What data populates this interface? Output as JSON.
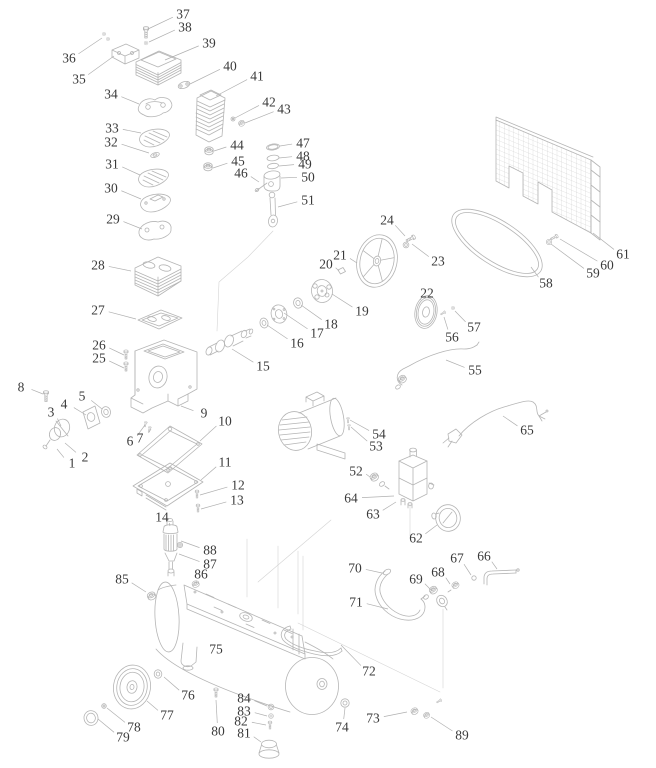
{
  "figure": {
    "type": "exploded-parts-diagram",
    "subject": "air compressor assembly",
    "part_count": 89
  },
  "style": {
    "background": "#ffffff",
    "linework_color": "#b5b5b5",
    "construction_line_color": "#d0d0d0",
    "leader_color": "#b0b0b0",
    "label_color": "#3a3a3a"
  },
  "canvas": {
    "width": 656,
    "height": 768
  },
  "labels": [
    {
      "n": "1",
      "x": 72,
      "y": 463,
      "tx": 57,
      "ty": 449
    },
    {
      "n": "2",
      "x": 85,
      "y": 457,
      "tx": 65,
      "ty": 443
    },
    {
      "n": "3",
      "x": 51,
      "y": 412,
      "tx": 61,
      "ty": 426
    },
    {
      "n": "4",
      "x": 64,
      "y": 404,
      "tx": 86,
      "ty": 415
    },
    {
      "n": "5",
      "x": 82,
      "y": 396,
      "tx": 102,
      "ty": 409
    },
    {
      "n": "6",
      "x": 130,
      "y": 441,
      "tx": 145,
      "ty": 425
    },
    {
      "n": "7",
      "x": 140,
      "y": 438,
      "tx": 151,
      "ty": 429
    },
    {
      "n": "8",
      "x": 21,
      "y": 387,
      "tx": 43,
      "ty": 394
    },
    {
      "n": "9",
      "x": 204,
      "y": 413,
      "tx": 181,
      "ty": 406
    },
    {
      "n": "10",
      "x": 225,
      "y": 421,
      "tx": 200,
      "ty": 441
    },
    {
      "n": "11",
      "x": 225,
      "y": 462,
      "tx": 201,
      "ty": 480
    },
    {
      "n": "12",
      "x": 238,
      "y": 485,
      "tx": 200,
      "ty": 495
    },
    {
      "n": "13",
      "x": 237,
      "y": 500,
      "tx": 201,
      "ty": 509
    },
    {
      "n": "14",
      "x": 162,
      "y": 517,
      "tx": 170,
      "ty": 526
    },
    {
      "n": "15",
      "x": 263,
      "y": 366,
      "tx": 232,
      "ty": 349
    },
    {
      "n": "16",
      "x": 297,
      "y": 343,
      "tx": 267,
      "ty": 325
    },
    {
      "n": "17",
      "x": 317,
      "y": 333,
      "tx": 284,
      "ty": 313
    },
    {
      "n": "18",
      "x": 331,
      "y": 324,
      "tx": 301,
      "ty": 305
    },
    {
      "n": "19",
      "x": 362,
      "y": 311,
      "tx": 332,
      "ty": 294
    },
    {
      "n": "20",
      "x": 326,
      "y": 264,
      "tx": 339,
      "ty": 271
    },
    {
      "n": "21",
      "x": 340,
      "y": 255,
      "tx": 357,
      "ty": 263
    },
    {
      "n": "22",
      "x": 427,
      "y": 293,
      "tx": 421,
      "ty": 300
    },
    {
      "n": "23",
      "x": 438,
      "y": 261,
      "tx": 412,
      "ty": 244
    },
    {
      "n": "24",
      "x": 387,
      "y": 220,
      "tx": 405,
      "ty": 236
    },
    {
      "n": "25",
      "x": 99,
      "y": 358,
      "tx": 124,
      "ty": 368
    },
    {
      "n": "26",
      "x": 99,
      "y": 345,
      "tx": 124,
      "ty": 355
    },
    {
      "n": "27",
      "x": 98,
      "y": 310,
      "tx": 136,
      "ty": 319
    },
    {
      "n": "28",
      "x": 98,
      "y": 265,
      "tx": 131,
      "ty": 271
    },
    {
      "n": "29",
      "x": 113,
      "y": 219,
      "tx": 142,
      "ty": 229
    },
    {
      "n": "30",
      "x": 111,
      "y": 188,
      "tx": 141,
      "ty": 199
    },
    {
      "n": "31",
      "x": 112,
      "y": 164,
      "tx": 140,
      "ty": 175
    },
    {
      "n": "32",
      "x": 111,
      "y": 142,
      "tx": 149,
      "ty": 153
    },
    {
      "n": "33",
      "x": 112,
      "y": 128,
      "tx": 141,
      "ty": 133
    },
    {
      "n": "34",
      "x": 111,
      "y": 94,
      "tx": 139,
      "ty": 104
    },
    {
      "n": "35",
      "x": 79,
      "y": 79,
      "tx": 114,
      "ty": 56
    },
    {
      "n": "36",
      "x": 69,
      "y": 58,
      "tx": 102,
      "ty": 38
    },
    {
      "n": "37",
      "x": 183,
      "y": 14,
      "tx": 148,
      "ty": 29
    },
    {
      "n": "38",
      "x": 185,
      "y": 27,
      "tx": 149,
      "ty": 42
    },
    {
      "n": "39",
      "x": 209,
      "y": 43,
      "tx": 165,
      "ty": 60
    },
    {
      "n": "40",
      "x": 230,
      "y": 66,
      "tx": 190,
      "ty": 84
    },
    {
      "n": "41",
      "x": 257,
      "y": 76,
      "tx": 216,
      "ty": 96
    },
    {
      "n": "42",
      "x": 269,
      "y": 102,
      "tx": 235,
      "ty": 118
    },
    {
      "n": "43",
      "x": 284,
      "y": 109,
      "tx": 245,
      "ty": 123
    },
    {
      "n": "44",
      "x": 237,
      "y": 145,
      "tx": 214,
      "ty": 151
    },
    {
      "n": "45",
      "x": 238,
      "y": 161,
      "tx": 213,
      "ty": 168
    },
    {
      "n": "46",
      "x": 241,
      "y": 173,
      "tx": 259,
      "ty": 182
    },
    {
      "n": "47",
      "x": 303,
      "y": 143,
      "tx": 280,
      "ty": 146
    },
    {
      "n": "48",
      "x": 303,
      "y": 156,
      "tx": 279,
      "ty": 158
    },
    {
      "n": "49",
      "x": 305,
      "y": 164,
      "tx": 279,
      "ty": 166
    },
    {
      "n": "50",
      "x": 308,
      "y": 177,
      "tx": 281,
      "ty": 178
    },
    {
      "n": "51",
      "x": 308,
      "y": 200,
      "tx": 278,
      "ty": 207
    },
    {
      "n": "52",
      "x": 356,
      "y": 471,
      "tx": 370,
      "ty": 477
    },
    {
      "n": "53",
      "x": 376,
      "y": 446,
      "tx": 351,
      "ty": 427
    },
    {
      "n": "54",
      "x": 379,
      "y": 434,
      "tx": 350,
      "ty": 420
    },
    {
      "n": "55",
      "x": 475,
      "y": 370,
      "tx": 446,
      "ty": 360
    },
    {
      "n": "56",
      "x": 452,
      "y": 337,
      "tx": 444,
      "ty": 317
    },
    {
      "n": "57",
      "x": 474,
      "y": 327,
      "tx": 455,
      "ty": 311
    },
    {
      "n": "58",
      "x": 546,
      "y": 283,
      "tx": 531,
      "ty": 267
    },
    {
      "n": "59",
      "x": 593,
      "y": 273,
      "tx": 551,
      "ty": 244
    },
    {
      "n": "60",
      "x": 607,
      "y": 265,
      "tx": 560,
      "ty": 239
    },
    {
      "n": "61",
      "x": 623,
      "y": 254,
      "tx": 593,
      "ty": 233
    },
    {
      "n": "62",
      "x": 416,
      "y": 538,
      "tx": 437,
      "ty": 525
    },
    {
      "n": "63",
      "x": 373,
      "y": 514,
      "tx": 396,
      "ty": 502
    },
    {
      "n": "64",
      "x": 351,
      "y": 498,
      "tx": 394,
      "ty": 496
    },
    {
      "n": "65",
      "x": 527,
      "y": 430,
      "tx": 503,
      "ty": 416
    },
    {
      "n": "66",
      "x": 484,
      "y": 556,
      "tx": 497,
      "ty": 569
    },
    {
      "n": "67",
      "x": 457,
      "y": 558,
      "tx": 471,
      "ty": 575
    },
    {
      "n": "68",
      "x": 438,
      "y": 572,
      "tx": 450,
      "ty": 584
    },
    {
      "n": "69",
      "x": 416,
      "y": 579,
      "tx": 431,
      "ty": 590
    },
    {
      "n": "70",
      "x": 355,
      "y": 568,
      "tx": 382,
      "ty": 573
    },
    {
      "n": "71",
      "x": 356,
      "y": 602,
      "tx": 388,
      "ty": 609
    },
    {
      "n": "72",
      "x": 369,
      "y": 671,
      "tx": 341,
      "ty": 645
    },
    {
      "n": "73",
      "x": 373,
      "y": 718,
      "tx": 407,
      "ty": 712
    },
    {
      "n": "74",
      "x": 342,
      "y": 727,
      "tx": 345,
      "ty": 708
    },
    {
      "n": "75",
      "x": 216,
      "y": 649
    },
    {
      "n": "76",
      "x": 188,
      "y": 695,
      "tx": 164,
      "ty": 677
    },
    {
      "n": "77",
      "x": 167,
      "y": 715,
      "tx": 147,
      "ty": 701
    },
    {
      "n": "78",
      "x": 134,
      "y": 727,
      "tx": 107,
      "ty": 708
    },
    {
      "n": "79",
      "x": 123,
      "y": 737,
      "tx": 98,
      "ty": 719
    },
    {
      "n": "80",
      "x": 218,
      "y": 731,
      "tx": 216,
      "ty": 700
    },
    {
      "n": "81",
      "x": 244,
      "y": 733,
      "tx": 261,
      "ty": 742
    },
    {
      "n": "82",
      "x": 241,
      "y": 721,
      "tx": 266,
      "ty": 725
    },
    {
      "n": "83",
      "x": 244,
      "y": 711,
      "tx": 267,
      "ty": 716
    },
    {
      "n": "84",
      "x": 244,
      "y": 698,
      "tx": 267,
      "ty": 706
    },
    {
      "n": "85",
      "x": 122,
      "y": 579,
      "tx": 146,
      "ty": 592
    },
    {
      "n": "86",
      "x": 201,
      "y": 574,
      "tx": 197,
      "ty": 583
    },
    {
      "n": "87",
      "x": 210,
      "y": 564,
      "tx": 179,
      "ty": 554
    },
    {
      "n": "88",
      "x": 210,
      "y": 550,
      "tx": 181,
      "ty": 541
    },
    {
      "n": "89",
      "x": 462,
      "y": 735,
      "tx": 431,
      "ty": 717
    }
  ]
}
